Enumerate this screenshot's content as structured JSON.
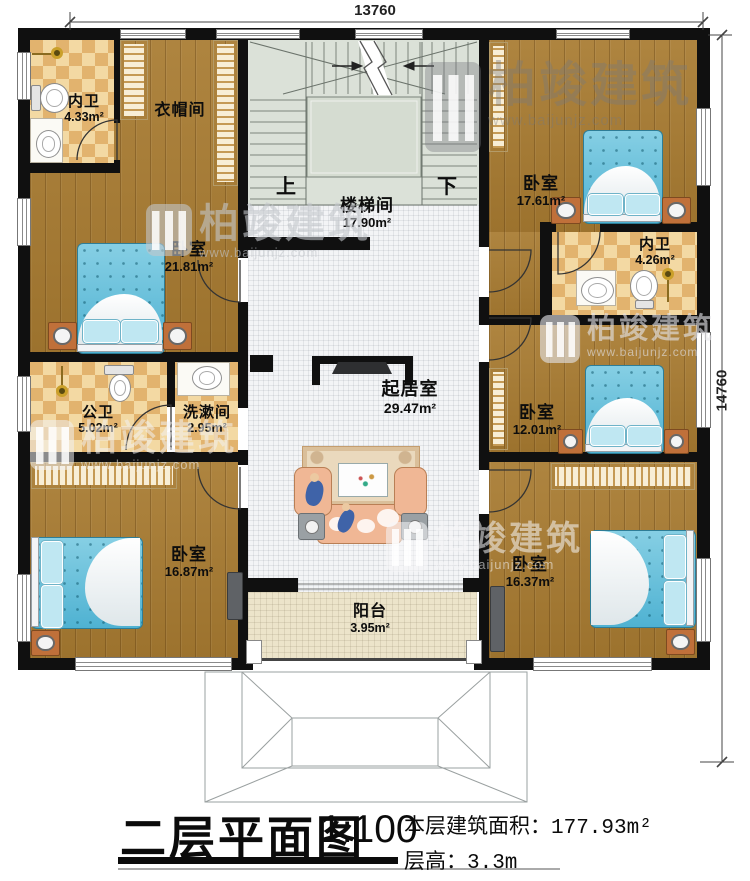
{
  "title": {
    "main": "二层平面图",
    "scale": "1:100",
    "area_label": "本层建筑面积：",
    "area_value": "177.93m²",
    "height_label": "层高：",
    "height_value": "3.3m"
  },
  "dims": {
    "top": "13760",
    "right": "14760"
  },
  "stair": {
    "up": "上",
    "down": "下"
  },
  "rooms": [
    {
      "id": "bath-top-left",
      "name": "内卫",
      "area": "4.33m²"
    },
    {
      "id": "cloakroom",
      "name": "衣帽间",
      "area": ""
    },
    {
      "id": "stairwell",
      "name": "楼梯间",
      "area": "17.90m²"
    },
    {
      "id": "bedroom-top-left",
      "name": "卧室",
      "area": "21.81m²"
    },
    {
      "id": "bedroom-top-right",
      "name": "卧室",
      "area": "17.61m²"
    },
    {
      "id": "bath-top-right",
      "name": "内卫",
      "area": "4.26m²"
    },
    {
      "id": "public-bath",
      "name": "公卫",
      "area": "5.02m²"
    },
    {
      "id": "washroom",
      "name": "洗漱间",
      "area": "2.95m²"
    },
    {
      "id": "living-room",
      "name": "起居室",
      "area": "29.47m²"
    },
    {
      "id": "bedroom-mid-right",
      "name": "卧室",
      "area": "12.01m²"
    },
    {
      "id": "bedroom-bot-left",
      "name": "卧室",
      "area": "16.87m²"
    },
    {
      "id": "bedroom-bot-right",
      "name": "卧室",
      "area": "16.37m²"
    },
    {
      "id": "balcony",
      "name": "阳台",
      "area": "3.95m²"
    }
  ],
  "watermark": {
    "brand": "柏竣建筑",
    "url": "www.baijunjz.com"
  },
  "colors": {
    "wall": "#101010",
    "wood": "#a87b31",
    "tile1": "#f3d9a3",
    "tile2": "#e2b36e",
    "hall": "#f3f4f6",
    "balcony": "#ece4ca",
    "stairbg": "#dbe1d8",
    "bedblue": "#86cfe4",
    "nightstand": "#c0703a",
    "wardrobe": "#f8eed6",
    "sofa": "#f0b795",
    "rug": "#ead9bd"
  }
}
